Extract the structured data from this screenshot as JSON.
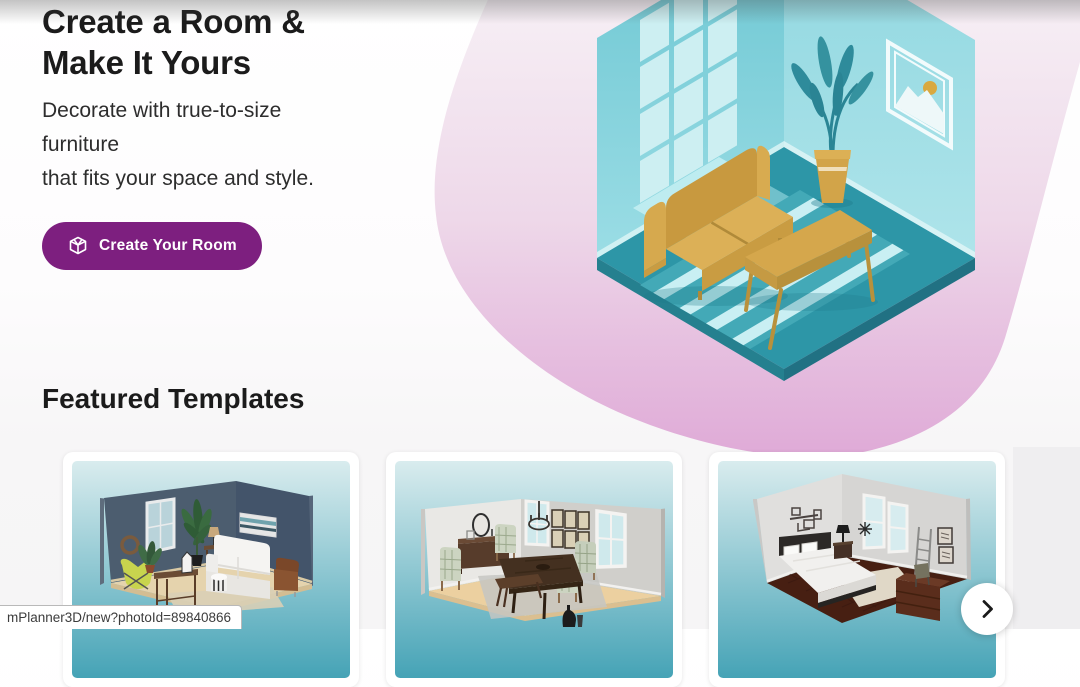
{
  "hero": {
    "title_line1": "Create a Room &",
    "title_line2": "Make It Yours",
    "subtitle_line1": "Decorate with true-to-size",
    "subtitle_line2": "furniture",
    "subtitle_line3": "that fits your space and style.",
    "cta_label": "Create Your Room"
  },
  "featured": {
    "heading": "Featured Templates"
  },
  "carousel": {
    "templates": [
      {
        "name": "living-room-template"
      },
      {
        "name": "dining-room-template"
      },
      {
        "name": "bedroom-template"
      }
    ]
  },
  "statusbar": {
    "url": "mPlanner3D/new?photoId=89840866"
  },
  "icons": {
    "cta_icon": "box-3d-icon",
    "next_icon": "chevron-right-icon"
  },
  "colors": {
    "accent_purple": "#7d1f7f",
    "blob_pink_top": "#f7f1f6",
    "blob_pink_bottom": "#dfaad7",
    "room_wall_teal": "#7fcfd9",
    "room_floor_teal": "#2d96a7",
    "card_gradient_top": "#d9ecee",
    "card_gradient_bottom": "#45a3b6"
  }
}
